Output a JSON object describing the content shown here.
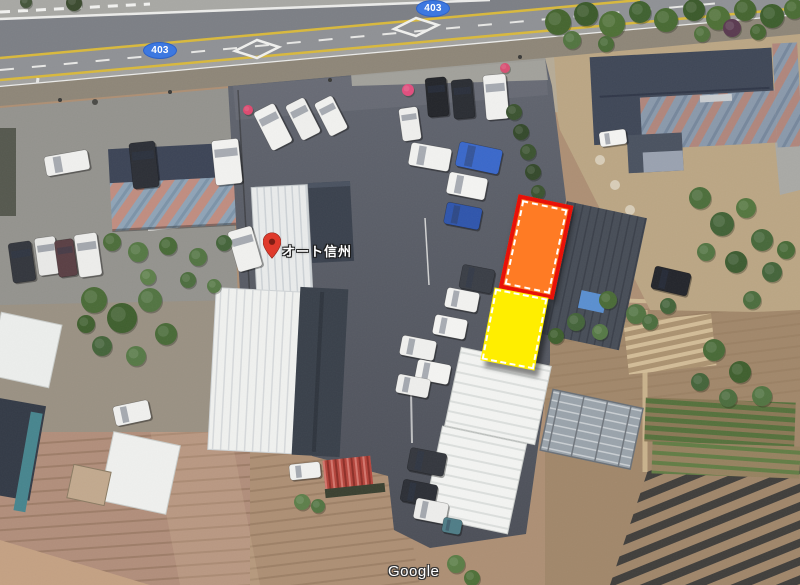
{
  "annotations": {
    "route_badges": [
      {
        "label": "403"
      },
      {
        "label": "403"
      }
    ],
    "place": {
      "label": "オート信州"
    },
    "watermark": "Google"
  },
  "colors": {
    "badge-blue": "#3d78e0",
    "badge-border": "#2d62c8",
    "pin-red": "#df3a2c",
    "pin-dot": "#7e1d14",
    "hl-orange": "#ff7b24",
    "hl-red": "#e81109",
    "hl-yellow": "#ffee00",
    "hl-dash": "#ffffff"
  },
  "scene": {
    "cars": [
      [
        67,
        163,
        44,
        20,
        -10,
        "#f0f0ee"
      ],
      [
        144,
        165,
        26,
        46,
        -6,
        "#2c2f36"
      ],
      [
        227,
        162,
        27,
        45,
        -6,
        "#f2f2f0"
      ],
      [
        22,
        262,
        23,
        40,
        -8,
        "#33363d"
      ],
      [
        47,
        256,
        21,
        38,
        -8,
        "#e9e9e7"
      ],
      [
        66,
        258,
        19,
        37,
        -8,
        "#5a3f44"
      ],
      [
        88,
        255,
        23,
        43,
        -8,
        "#ededeb"
      ],
      [
        245,
        249,
        25,
        42,
        -16,
        "#f1f1ef"
      ],
      [
        273,
        127,
        23,
        43,
        -27,
        "#f2f2f0"
      ],
      [
        303,
        119,
        21,
        39,
        -27,
        "#efefed"
      ],
      [
        331,
        116,
        20,
        37,
        -27,
        "#f1f1ef"
      ],
      [
        437,
        97,
        21,
        39,
        -5,
        "#23252a"
      ],
      [
        463,
        99,
        21,
        39,
        -5,
        "#2a2d33"
      ],
      [
        496,
        97,
        23,
        45,
        -5,
        "#f1f1ef"
      ],
      [
        410,
        124,
        19,
        33,
        -8,
        "#efefed"
      ],
      [
        479,
        158,
        44,
        25,
        12,
        "#3a68ca"
      ],
      [
        430,
        157,
        41,
        23,
        10,
        "#f2f2f0"
      ],
      [
        467,
        186,
        39,
        22,
        11,
        "#f4f4f2"
      ],
      [
        463,
        216,
        36,
        22,
        11,
        "#2f55ac"
      ],
      [
        477,
        279,
        33,
        24,
        11,
        "#3a3e46"
      ],
      [
        462,
        300,
        33,
        20,
        11,
        "#f2f2f0"
      ],
      [
        450,
        327,
        33,
        20,
        11,
        "#f4f4f2"
      ],
      [
        418,
        348,
        35,
        20,
        11,
        "#f0f0ee"
      ],
      [
        433,
        372,
        34,
        20,
        11,
        "#f4f4f2"
      ],
      [
        413,
        386,
        33,
        19,
        11,
        "#eeeeec"
      ],
      [
        427,
        462,
        37,
        23,
        11,
        "#34373e"
      ],
      [
        419,
        493,
        35,
        22,
        11,
        "#2c2f36"
      ],
      [
        431,
        511,
        33,
        21,
        11,
        "#ededeb"
      ],
      [
        452,
        526,
        19,
        15,
        11,
        "#4f7d87"
      ],
      [
        132,
        413,
        36,
        20,
        -12,
        "#f0f0ee"
      ],
      [
        671,
        281,
        37,
        23,
        13,
        "#23252b"
      ],
      [
        613,
        138,
        27,
        15,
        -8,
        "#f4f4f2"
      ],
      [
        305,
        471,
        31,
        16,
        -6,
        "#f1f1ef"
      ]
    ],
    "trees": [
      [
        558,
        22,
        13,
        "#45652f"
      ],
      [
        586,
        14,
        12,
        "#3b5a2b"
      ],
      [
        612,
        24,
        13,
        "#4e7036"
      ],
      [
        640,
        12,
        11,
        "#3f6130"
      ],
      [
        666,
        20,
        12,
        "#486a33"
      ],
      [
        694,
        10,
        11,
        "#3b5a2b"
      ],
      [
        718,
        18,
        12,
        "#4e7036"
      ],
      [
        745,
        10,
        11,
        "#456530"
      ],
      [
        772,
        16,
        12,
        "#3d5e2d"
      ],
      [
        794,
        9,
        10,
        "#4a6c34"
      ],
      [
        572,
        40,
        9,
        "#527440"
      ],
      [
        606,
        44,
        8,
        "#496b37"
      ],
      [
        702,
        34,
        8,
        "#50713c"
      ],
      [
        758,
        32,
        8,
        "#466632"
      ],
      [
        732,
        28,
        9,
        "#5a3a50"
      ],
      [
        74,
        3,
        8,
        "#3a4a2e"
      ],
      [
        26,
        2,
        6,
        "#44553a"
      ],
      [
        112,
        242,
        9,
        "#4c6d3a"
      ],
      [
        138,
        252,
        10,
        "#557844"
      ],
      [
        168,
        246,
        9,
        "#486a37"
      ],
      [
        198,
        257,
        9,
        "#527442"
      ],
      [
        224,
        243,
        8,
        "#44643a"
      ],
      [
        148,
        277,
        8,
        "#5d7f4a"
      ],
      [
        188,
        280,
        8,
        "#4c6d3e"
      ],
      [
        214,
        286,
        7,
        "#567946"
      ],
      [
        94,
        300,
        13,
        "#4a6b37"
      ],
      [
        122,
        318,
        15,
        "#3f5f2e"
      ],
      [
        150,
        300,
        12,
        "#527442"
      ],
      [
        166,
        334,
        11,
        "#486a37"
      ],
      [
        102,
        346,
        10,
        "#44643a"
      ],
      [
        136,
        356,
        10,
        "#567946"
      ],
      [
        86,
        324,
        9,
        "#3f5f2e"
      ],
      [
        514,
        112,
        8,
        "#3b5330"
      ],
      [
        521,
        132,
        8,
        "#34492b"
      ],
      [
        528,
        152,
        8,
        "#3b5330"
      ],
      [
        533,
        172,
        8,
        "#34492b"
      ],
      [
        538,
        192,
        7,
        "#3b5330"
      ],
      [
        542,
        209,
        7,
        "#34492b"
      ],
      [
        700,
        198,
        11,
        "#4c6e3b"
      ],
      [
        722,
        224,
        12,
        "#426236"
      ],
      [
        746,
        208,
        10,
        "#54763f"
      ],
      [
        762,
        240,
        11,
        "#47683a"
      ],
      [
        736,
        262,
        11,
        "#3d5c31"
      ],
      [
        706,
        252,
        9,
        "#527442"
      ],
      [
        772,
        272,
        10,
        "#44643a"
      ],
      [
        752,
        300,
        9,
        "#4c6d3e"
      ],
      [
        786,
        250,
        9,
        "#486a37"
      ],
      [
        608,
        300,
        9,
        "#4a6b37"
      ],
      [
        636,
        314,
        10,
        "#527442"
      ],
      [
        576,
        322,
        9,
        "#44643a"
      ],
      [
        556,
        336,
        8,
        "#3f5f2e"
      ],
      [
        600,
        332,
        8,
        "#567946"
      ],
      [
        650,
        322,
        8,
        "#4c6d3e"
      ],
      [
        668,
        306,
        8,
        "#44643a"
      ],
      [
        714,
        350,
        11,
        "#486a37"
      ],
      [
        740,
        372,
        11,
        "#3f5f2e"
      ],
      [
        762,
        396,
        10,
        "#527442"
      ],
      [
        700,
        382,
        9,
        "#44643a"
      ],
      [
        728,
        398,
        9,
        "#4c6d3e"
      ],
      [
        456,
        564,
        9,
        "#5a7d46"
      ],
      [
        472,
        578,
        8,
        "#4e7038"
      ],
      [
        302,
        502,
        8,
        "#5d7f4a"
      ],
      [
        318,
        506,
        7,
        "#527442"
      ],
      [
        408,
        90,
        6,
        "#e14e7e"
      ],
      [
        248,
        110,
        5,
        "#dd4a70"
      ],
      [
        505,
        68,
        5,
        "#d84f72"
      ]
    ]
  }
}
